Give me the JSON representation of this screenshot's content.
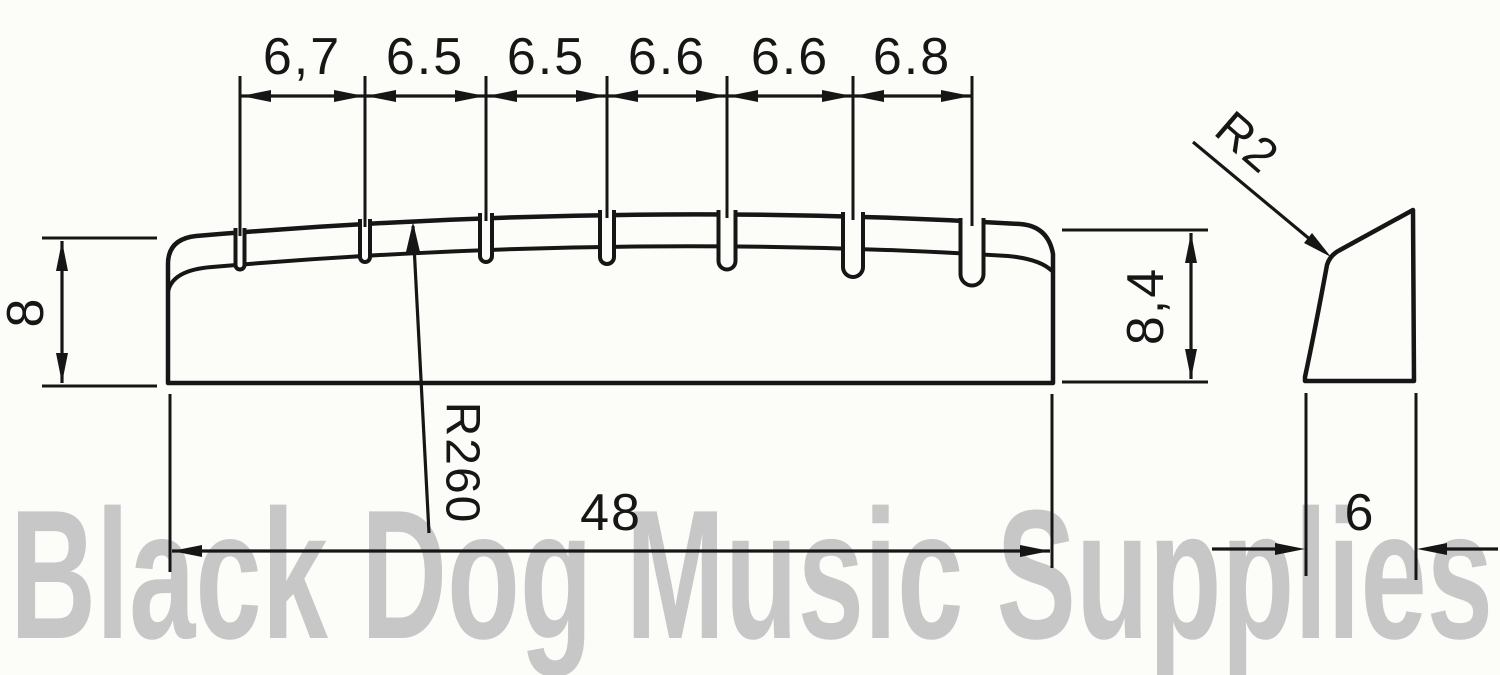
{
  "watermark": {
    "text": "Black Dog Music Supplies",
    "color": "#c7c7c7"
  },
  "front_view": {
    "slot_spacing_labels": [
      "6,7",
      "6.5",
      "6.5",
      "6.6",
      "6.6",
      "6.8"
    ],
    "left_height_label": "8",
    "right_height_label": "8,4",
    "crown_radius_label": "R260",
    "overall_width_label": "48"
  },
  "side_view": {
    "corner_radius_label": "R2",
    "thickness_label": "6"
  },
  "colors": {
    "line": "#161616",
    "background": "#fcfcf9",
    "watermark": "#c7c7c7"
  }
}
